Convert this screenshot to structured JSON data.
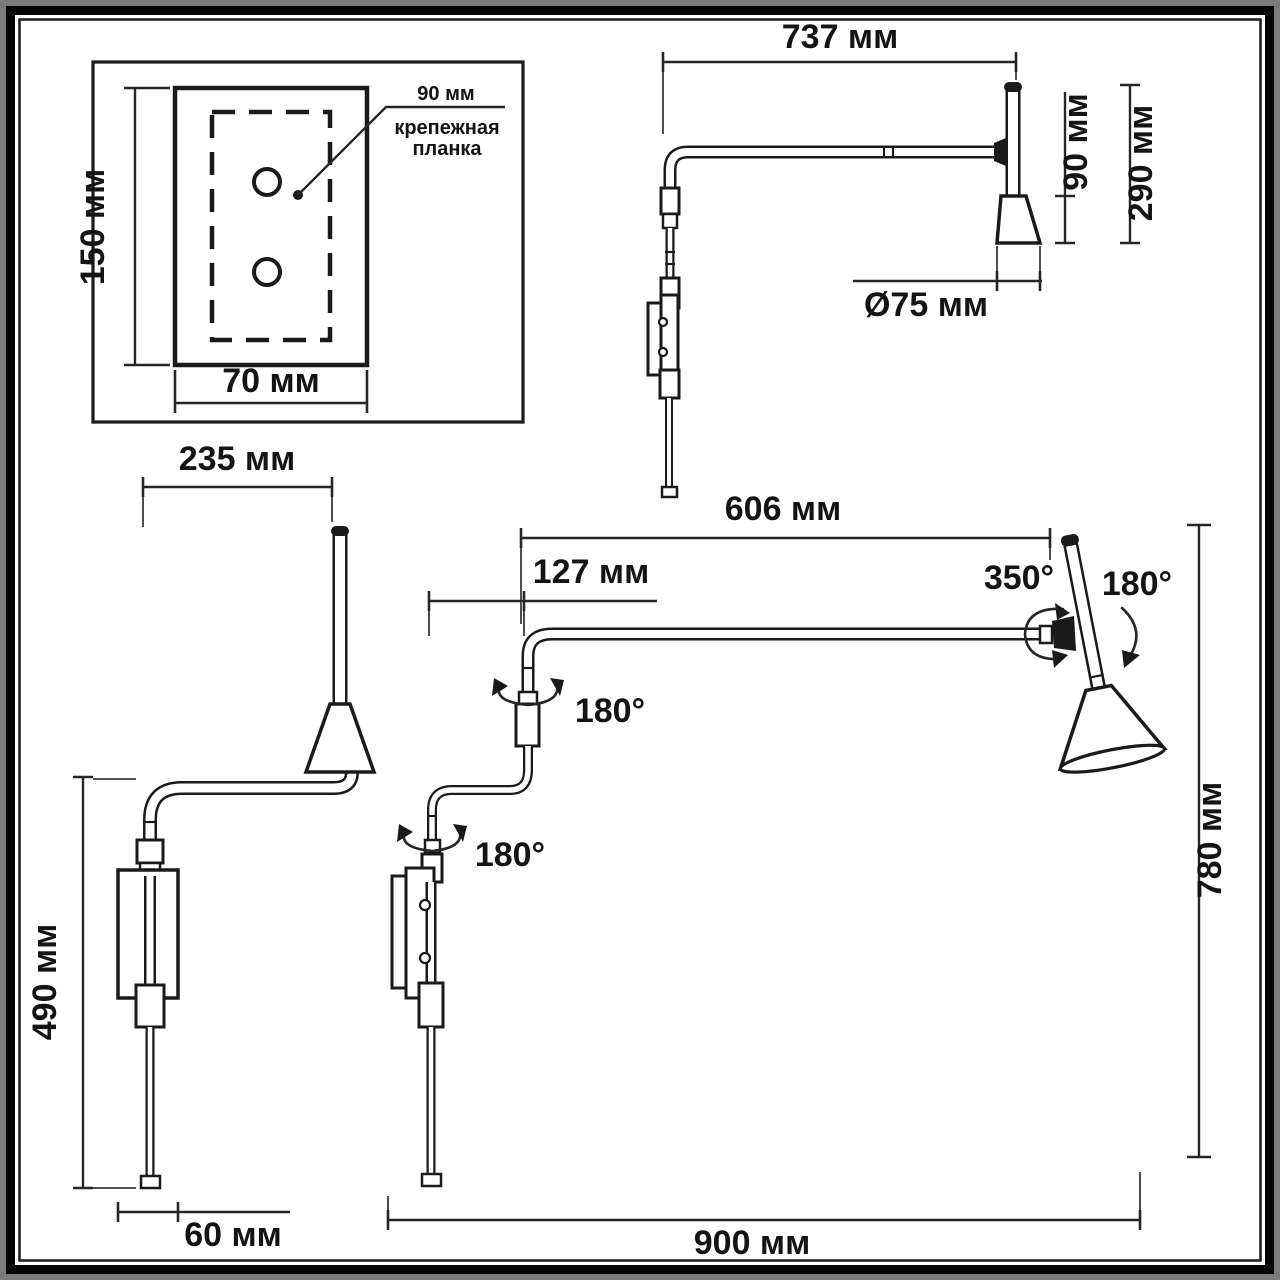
{
  "title": "wall-lamp-dimension-drawing",
  "colors": {
    "line": "#1a1a1a",
    "dimension": "#262626",
    "background": "#ffffff",
    "frame": "#050505",
    "outer_border": "#7b7b7b"
  },
  "views": {
    "mounting_plate": {
      "plate_height": "150 мм",
      "plate_width": "70 мм",
      "bracket_width": "90 мм",
      "bracket_name_line1": "крепежная",
      "bracket_name_line2": "планка"
    },
    "upper_side": {
      "arm_length": "737 мм",
      "shade_height": "90 мм",
      "head_height": "290 мм",
      "shade_diameter": "Ø75 мм"
    },
    "front": {
      "arm_reach": "235 мм",
      "column_height": "490 мм",
      "plate_width": "60 мм"
    },
    "main_side": {
      "arm_length": "606 мм",
      "arm_offset": "127 мм",
      "joint_upper_rotation": "180°",
      "joint_lower_rotation": "180°",
      "head_rotation": "350°",
      "head_tilt": "180°",
      "total_height": "780 мм",
      "total_reach": "900 мм"
    }
  }
}
